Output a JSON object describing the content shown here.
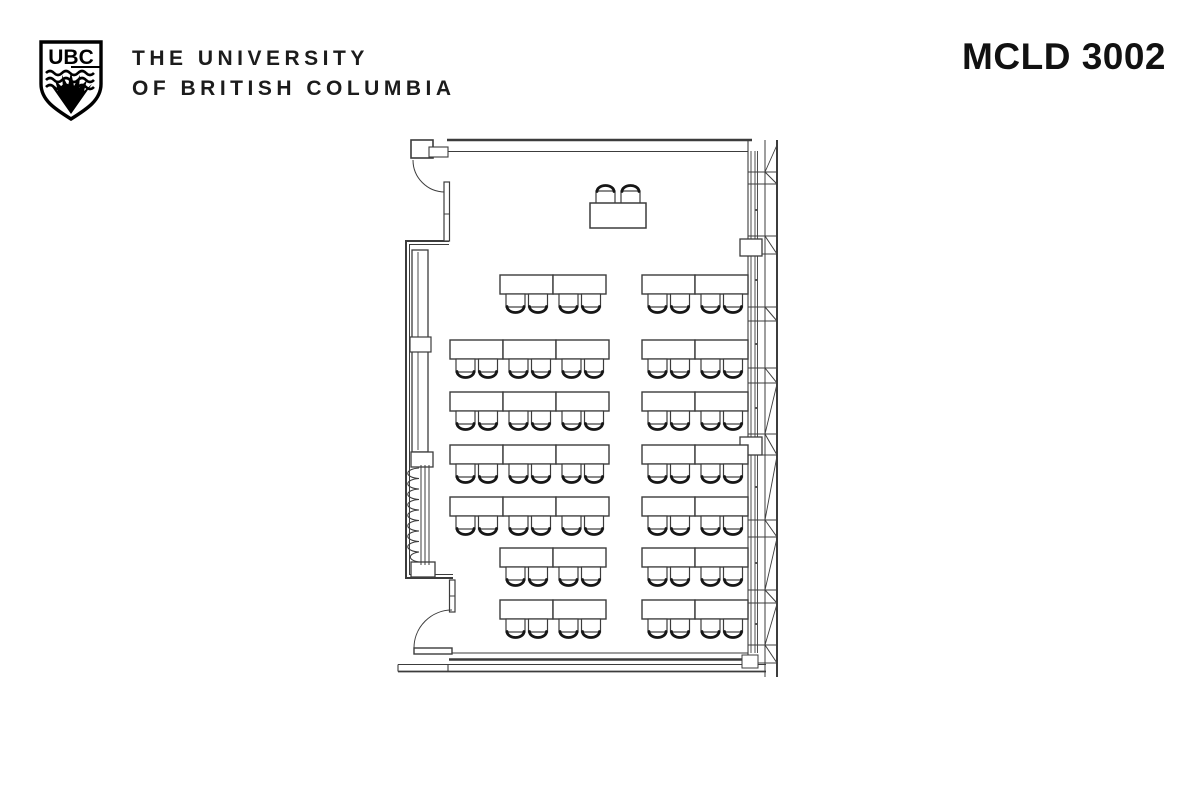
{
  "header": {
    "logo_acronym": "UBC",
    "institution_line1": "THE UNIVERSITY",
    "institution_line2": "OF BRITISH COLUMBIA",
    "room_number": "MCLD 3002"
  },
  "floor_plan": {
    "kind": "classroom seating plan",
    "line_color": "#3c3c3c",
    "chair_back_color": "#161616",
    "table_size": {
      "width": 53,
      "height": 19
    },
    "chair_size": {
      "width": 19,
      "height": 13,
      "back_depth": 6
    },
    "chairs_per_table": 2,
    "instructor_station": {
      "desk": {
        "x": 590,
        "y": 203,
        "width": 56,
        "height": 25
      },
      "chairs": 2,
      "facing": "up"
    },
    "rows": [
      {
        "y": 275,
        "blocks": [
          {
            "x": 500,
            "tables": 2
          },
          {
            "x": 642,
            "tables": 2
          }
        ]
      },
      {
        "y": 340,
        "blocks": [
          {
            "x": 450,
            "tables": 3
          },
          {
            "x": 642,
            "tables": 2
          }
        ]
      },
      {
        "y": 392,
        "blocks": [
          {
            "x": 450,
            "tables": 3
          },
          {
            "x": 642,
            "tables": 2
          }
        ]
      },
      {
        "y": 445,
        "blocks": [
          {
            "x": 450,
            "tables": 3
          },
          {
            "x": 642,
            "tables": 2
          }
        ]
      },
      {
        "y": 497,
        "blocks": [
          {
            "x": 450,
            "tables": 3
          },
          {
            "x": 642,
            "tables": 2
          }
        ]
      },
      {
        "y": 548,
        "blocks": [
          {
            "x": 500,
            "tables": 2
          },
          {
            "x": 642,
            "tables": 2
          }
        ]
      },
      {
        "y": 600,
        "blocks": [
          {
            "x": 500,
            "tables": 2
          },
          {
            "x": 642,
            "tables": 2
          }
        ]
      }
    ],
    "total_student_tables": 32,
    "total_student_seats": 64
  }
}
